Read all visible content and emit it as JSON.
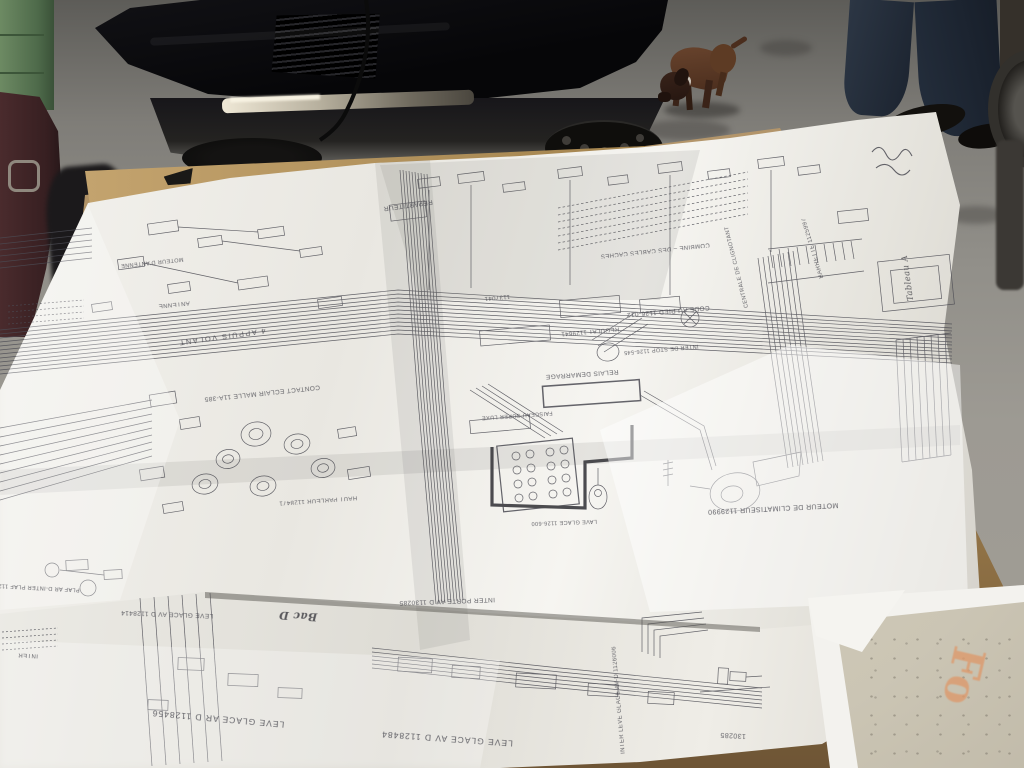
{
  "diagram": {
    "labels": [
      {
        "text": "CONTACT ECLAIR MALLE 11A-385"
      },
      {
        "text": "4 APPUIS VOLANT"
      },
      {
        "text": "ANTENNE"
      },
      {
        "text": "MOTEUR D'ANTENNE"
      },
      {
        "text": "HAUT PARLEUR 1128471"
      },
      {
        "text": "REPARTITEUR"
      },
      {
        "text": "COMBINE – DES CABLES CACHES"
      },
      {
        "text": "BARRETTE 1125997"
      },
      {
        "text": "CENTRALE DE CLIGNOTANT"
      },
      {
        "text": "CODE AU PIED 1126-012"
      },
      {
        "text": "INTER DE STOP 1126-545"
      },
      {
        "text": "1137041"
      },
      {
        "text": "REGULAT 1129641"
      },
      {
        "text": "RELAIS DEMARRAGE"
      },
      {
        "text": "LAVE GLACE 1126-600"
      },
      {
        "text": "MOTEUR DE CLIMATISEUR 1129990"
      },
      {
        "text": "INTER LEVE GLACE AV-D 1126006"
      },
      {
        "text": "INTER PORTE AV D 1130285"
      },
      {
        "text": "LEVE GLACE AV D 1128414"
      },
      {
        "text": "LEVE GLACE AR D 1128456"
      },
      {
        "text": "LEVE GLACE AV D 1128484"
      },
      {
        "text": "130285"
      },
      {
        "text": "PLAF AR D-INTER PLAF 1126193"
      },
      {
        "text": "INTER"
      },
      {
        "text": "FAISCEAU SUPER LUXE"
      }
    ],
    "handwritten": [
      {
        "text": "Bac D"
      },
      {
        "text": "Tableau A"
      }
    ]
  },
  "folder": {
    "text": "Fo"
  },
  "colors": {
    "paper": "#f1f0ec",
    "paper_shade": "#d9d6cf",
    "ink": "#4b4b53",
    "table": "#ab8c5f",
    "table_dark": "#6e5535",
    "floor": "#918f89",
    "car": "#0c0c0e",
    "dog": "#53351f",
    "denim": "#242e3c",
    "cabinet": "#5f7d57",
    "accent": "#dd9a6d"
  }
}
